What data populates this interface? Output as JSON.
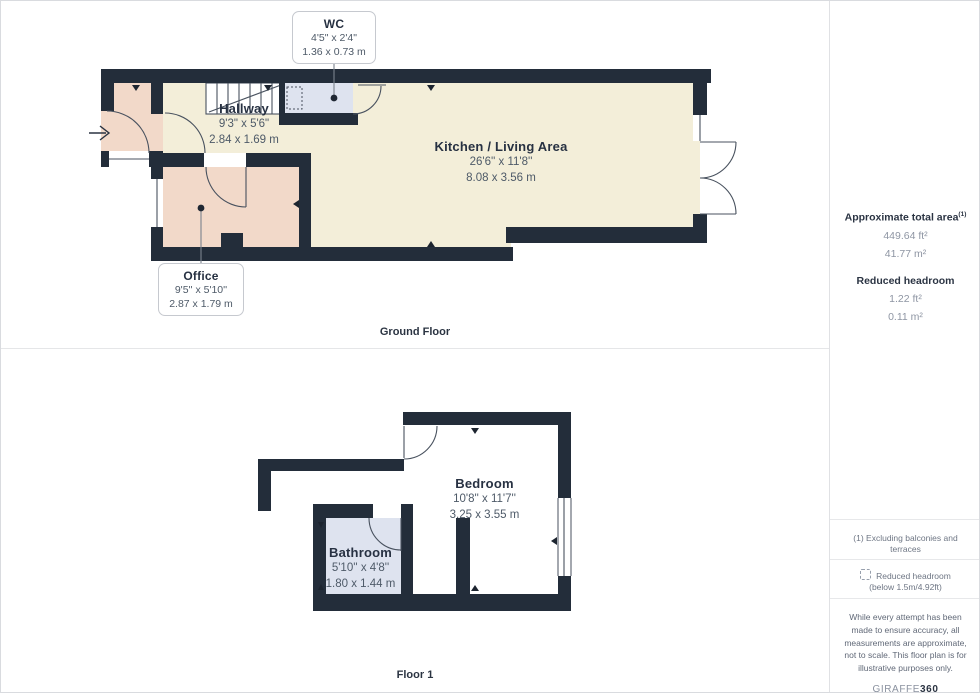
{
  "ground_floor": {
    "section_label": "Ground Floor",
    "rooms": {
      "wc": {
        "name": "WC",
        "imperial": "4'5\" x 2'4\"",
        "metric": "1.36 x 0.73 m"
      },
      "hallway": {
        "name": "Hallway",
        "imperial": "9'3\" x 5'6\"",
        "metric": "2.84 x 1.69 m"
      },
      "kitchen": {
        "name": "Kitchen / Living Area",
        "imperial": "26'6'' x 11'8''",
        "metric": "8.08 x 3.56 m"
      },
      "office": {
        "name": "Office",
        "imperial": "9'5'' x 5'10''",
        "metric": "2.87 x 1.79 m"
      }
    }
  },
  "floor_1": {
    "section_label": "Floor 1",
    "rooms": {
      "bedroom": {
        "name": "Bedroom",
        "imperial": "10'8'' x 11'7''",
        "metric": "3.25 x 3.55 m"
      },
      "bathroom": {
        "name": "Bathroom",
        "imperial": "5'10'' x 4'8''",
        "metric": "1.80 x 1.44 m"
      }
    }
  },
  "sidebar": {
    "total_area": {
      "label": "Approximate total area",
      "superscript": "(1)",
      "value_ft": "449.64 ft²",
      "value_m": "41.77 m²"
    },
    "reduced_headroom": {
      "label": "Reduced headroom",
      "value_ft": "1.22 ft²",
      "value_m": "0.11 m²"
    },
    "footnote_1": "(1) Excluding balconies and terraces",
    "legend": {
      "line1": "Reduced headroom",
      "line2": "(below 1.5m/4.92ft)"
    },
    "disclaimer": "While every attempt has been made to ensure accuracy, all measurements are approximate, not to scale. This floor plan is for illustrative purposes only.",
    "brand": {
      "name": "GIRAFFE",
      "suffix": "360"
    }
  },
  "colors": {
    "wall": "#232d3a",
    "room_beige": "#f3eed9",
    "room_pink": "#f2d9c9",
    "room_blue": "#dee3ef",
    "text_dark": "#273142",
    "text_dim": "#4e5a68"
  }
}
